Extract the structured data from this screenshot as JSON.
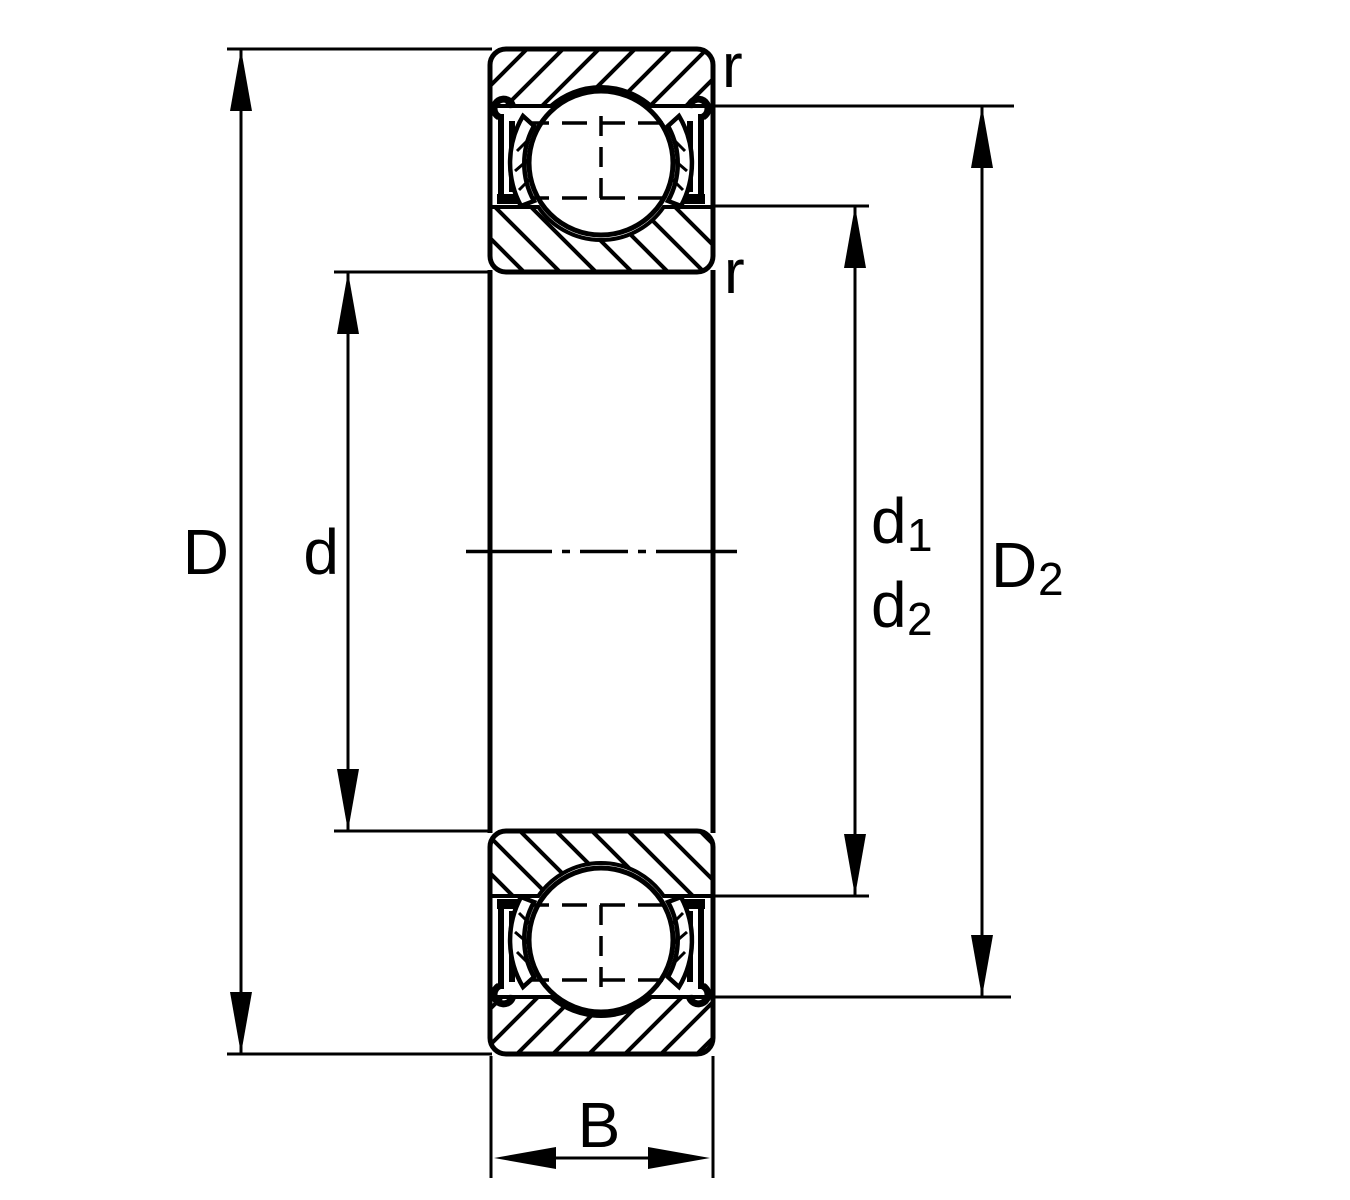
{
  "diagram": {
    "name": "deep-groove-ball-bearing-cross-section",
    "description": "Sectional technical drawing of a shielded deep groove ball bearing with dimension lines",
    "background_color": "#ffffff",
    "line_color": "#000000"
  },
  "labels": {
    "outer_diameter": "D",
    "bore_diameter": "d",
    "d1": {
      "base": "d",
      "sub": "1"
    },
    "d2": {
      "base": "d",
      "sub": "2"
    },
    "D2": {
      "base": "D",
      "sub": "2"
    },
    "width": "B",
    "chamfer_outer": "r",
    "chamfer_inner": "r"
  }
}
